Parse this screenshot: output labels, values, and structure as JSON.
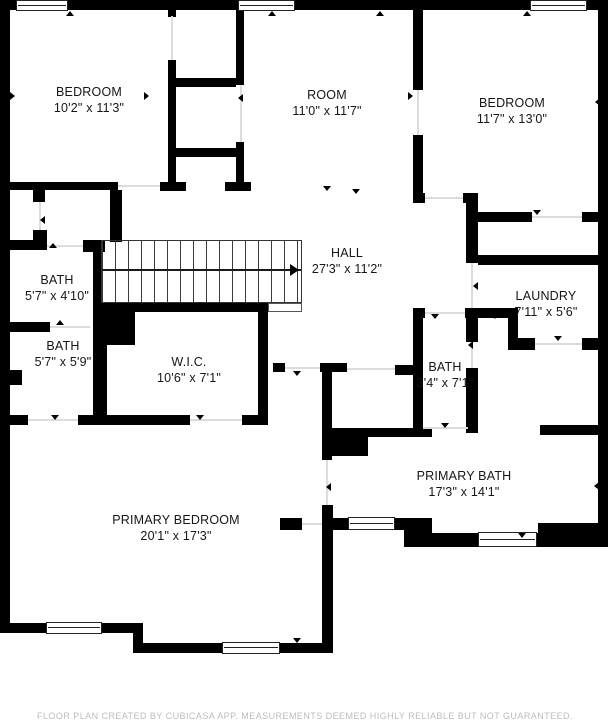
{
  "rooms": [
    {
      "id": "bedroom-top-left",
      "name": "BEDROOM",
      "dims": "10'2\" x 11'3\""
    },
    {
      "id": "room",
      "name": "ROOM",
      "dims": "11'0\" x 11'7\""
    },
    {
      "id": "bedroom-top-right",
      "name": "BEDROOM",
      "dims": "11'7\" x 13'0\""
    },
    {
      "id": "hall",
      "name": "HALL",
      "dims": "27'3\" x 11'2\""
    },
    {
      "id": "bath-upper",
      "name": "BATH",
      "dims": "5'7\" x 4'10\""
    },
    {
      "id": "bath-lower",
      "name": "BATH",
      "dims": "5'7\" x 5'9\""
    },
    {
      "id": "wic",
      "name": "W.I.C.",
      "dims": "10'6\" x 7'1\""
    },
    {
      "id": "laundry",
      "name": "LAUNDRY",
      "dims": "7'11\" x 5'6\""
    },
    {
      "id": "bath-middle",
      "name": "BATH",
      "dims": "3'4\" x 7'1\""
    },
    {
      "id": "primary-bath",
      "name": "PRIMARY BATH",
      "dims": "17'3\" x 14'1\""
    },
    {
      "id": "primary-bedroom",
      "name": "PRIMARY BEDROOM",
      "dims": "20'1\" x 17'3\""
    }
  ],
  "footer": {
    "disclaimer": "FLOOR PLAN CREATED BY CUBICASA APP. MEASUREMENTS DEEMED HIGHLY RELIABLE BUT NOT GUARANTEED."
  },
  "colors": {
    "wall": "#000000",
    "background": "#ffffff",
    "footer_text": "#bcbcbc"
  }
}
